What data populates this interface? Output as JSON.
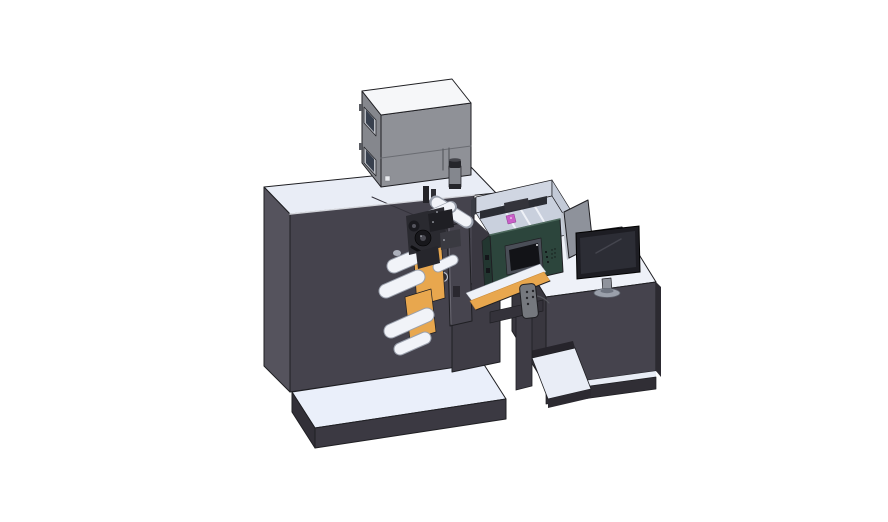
{
  "scene": {
    "description": "Isometric 3D CAD render of a compact label printing and converting machine: dark machine body on a light base platform, gray electrical enclosure box on top, signal beacon, black print-head mechanism with white unwind rollers and orange web material, teal HMI control panel with touchscreen, light print tray with magenta ink cartridge, hanging pendant remote, and an operator desk with a monitor and divider panel on a white background.",
    "width": 888,
    "height": 522,
    "background": "#ffffff"
  },
  "colors": {
    "outline": "#1f1f23",
    "machine_front": "#45434d",
    "machine_left": "#55535d",
    "machine_top": "#e9edf6",
    "machine_chamfer": "#f2f5fa",
    "platform_top": "#eaeffa",
    "platform_front": "#3b3942",
    "platform_left": "#323038",
    "box_front": "#8f9197",
    "box_left": "#85878d",
    "box_top": "#f6f7f9",
    "box_seam": "#6a6c72",
    "window_frame": "#b9bcc2",
    "window_glass": "#38404e",
    "beacon_body": "#84878e",
    "beacon_dark": "#25262b",
    "roller": "#f1f3f8",
    "roller_edge": "#9aa0ac",
    "web_orange": "#e8a74e",
    "web_orange_dark": "#c98937",
    "head_dark": "#232328",
    "head_mid": "#3a3a41",
    "door_panel": "#46444e",
    "hmi_green": "#2c453c",
    "hmi_green_side": "#223630",
    "screen_bezel": "#4a4e57",
    "screen_black": "#121317",
    "tray_wall": "#d0d6e2",
    "tray_wall_right": "#c3cad7",
    "tray_floor": "#c9d0dd",
    "tray_interior": "#2b2d34",
    "slat_white": "#eef1f7",
    "ink_pink": "#c95fc8",
    "divider_gray": "#8e929b",
    "divider_edge": "#c0c5ce",
    "monitor_bezel": "#1d1d23",
    "monitor_screen": "#2c2d35",
    "monitor_reflection": "#44454e",
    "stand_gray": "#8f939c",
    "base_gray": "#9aa0ab",
    "desk_top": "#eef1f8",
    "desk_front": "#45434d",
    "desk_left": "#39373f",
    "desk_skirt": "#302e35",
    "shelf_top": "#e9edf6",
    "pendant_gray": "#75787e",
    "support_dark": "#34323a",
    "column_dark": "#3e3c45",
    "under_tray": "#3a3841",
    "seam_dark": "#33313a",
    "detail_dark": "#26262c",
    "detail_light": "#cfd3dc"
  },
  "components": {
    "machine_body": {
      "label": "Main machine body"
    },
    "base_platform": {
      "label": "Machine base platform"
    },
    "electrical_enclosure": {
      "label": "Electrical enclosure box on machine top"
    },
    "signal_beacon": {
      "label": "Signal beacon / filter cylinder"
    },
    "print_head": {
      "label": "Print head mechanism"
    },
    "unwind_rollers": {
      "label": "Unwind guide rollers"
    },
    "web_material": {
      "label": "Orange web material path"
    },
    "door_panel": {
      "label": "Mechanism door panel"
    },
    "hmi_panel": {
      "label": "HMI control panel"
    },
    "hmi_screen": {
      "label": "HMI touchscreen"
    },
    "print_tray": {
      "label": "Print zone tray"
    },
    "ink_cartridge": {
      "label": "Magenta ink cartridge"
    },
    "pendant_remote": {
      "label": "Pendant remote control"
    },
    "support_leg": {
      "label": "Support leg and bracket"
    },
    "operator_desk": {
      "label": "Operator desk"
    },
    "desk_shelf": {
      "label": "Desk lower shelf"
    },
    "monitor": {
      "label": "Desktop monitor"
    },
    "monitor_stand": {
      "label": "Monitor stand"
    },
    "divider_panel": {
      "label": "Gray divider panel behind monitor"
    }
  }
}
